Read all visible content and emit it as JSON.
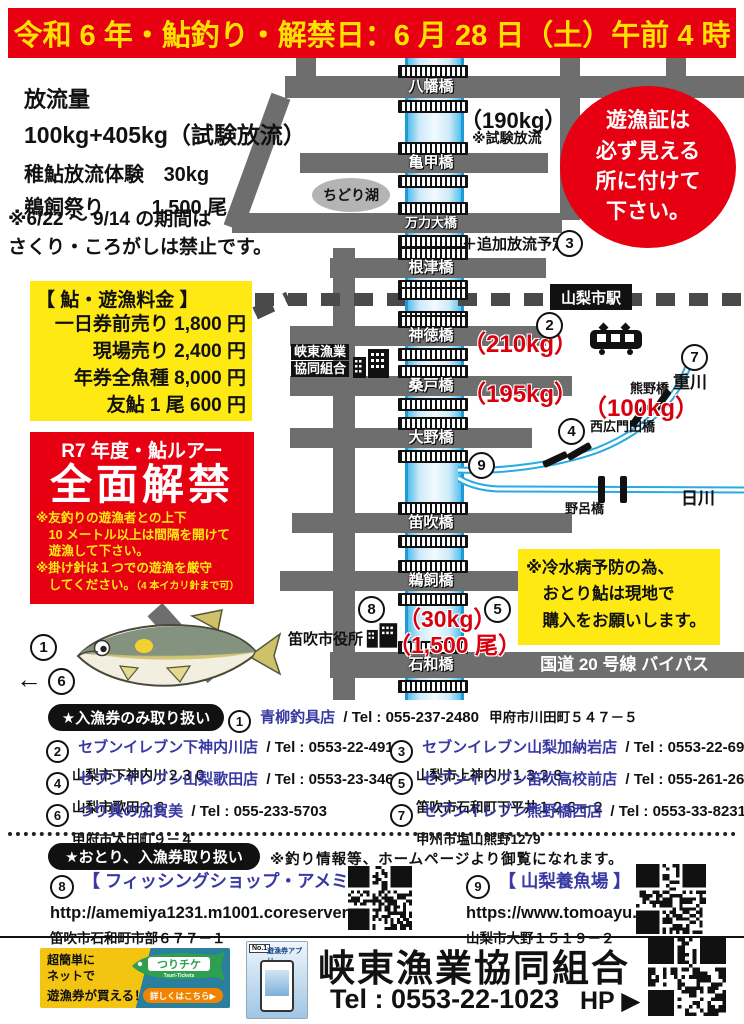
{
  "header": {
    "title": "令和 6 年・鮎釣り・解禁日：6 月 28 日（土）午前 4 時"
  },
  "info": {
    "title": "放流量",
    "amount": "100kg+405kg（試験放流）",
    "row1_label": "稚鮎放流体験",
    "row1_value": "30kg",
    "row2_label": "鵜飼祭り",
    "row2_value": "1,500 尾",
    "note_line1": "※6/22 ～ 9/14 の期間は",
    "note_line2": "さくり・ころがしは禁止です。"
  },
  "license_notice": {
    "lines": [
      "遊漁証は",
      "必ず見える",
      "所に付けて",
      "下さい。"
    ]
  },
  "fees": {
    "title": "【 鮎・遊漁料金 】",
    "items": [
      "一日券前売り 1,800 円",
      "現場売り 2,400 円",
      "年券全魚種 8,000 円",
      "友鮎 1 尾 600 円"
    ]
  },
  "lure": {
    "subtitle": "R7 年度・鮎ルアー",
    "title": "全面解禁",
    "note1_lines": [
      "※友釣りの遊漁者との上下",
      "　10 メートル以上は間隔を開けて",
      "　遊漁して下さい。"
    ],
    "note2_line1": "※掛け針は１つでの遊漁を厳守",
    "note2_line2": "　してください。",
    "note2_small": "（4 本イカリ針まで可）"
  },
  "map": {
    "bridges": [
      "八幡橋",
      "亀甲橋",
      "万力大橋",
      "根津橋",
      "神徳橋",
      "桑戸橋",
      "大野橋",
      "笛吹橋",
      "鵜飼橋",
      "石和橋"
    ],
    "lake": "ちどり湖",
    "station": "山梨市駅",
    "coop_line1": "峡東漁業",
    "coop_line2": "協同組合",
    "city_hall": "笛吹市役所",
    "highway": "国道 20 号線 バイパス",
    "stock_190": "（190kg）",
    "stock_190_note": "※試験放流",
    "additional": "＋追加放流予定",
    "stock_210": "（210kg）",
    "stock_195": "（195kg）",
    "kumano_bridge": "熊野橋",
    "stock_100": "（100kg）",
    "nishihiromonda_bridge": "西広門田橋",
    "shige_river": "重川",
    "hi_river": "日川",
    "noro_bridge": "野呂橋",
    "stock_30": "（30kg）",
    "stock_1500": "（1,500 尾）",
    "cold_note_lines": [
      "※冷水病予防の為、",
      "　おとり鮎は現地で",
      "　購入をお願いします。"
    ],
    "arrow_left": "←",
    "markers": {
      "m1": "1",
      "m2": "2",
      "m3": "3",
      "m4": "4",
      "m5": "5",
      "m6": "6",
      "m7": "7",
      "m8": "8",
      "m9": "9"
    }
  },
  "shops": {
    "badge": "★入漁券のみ取り扱い",
    "list": [
      {
        "no": "1",
        "name": "青柳釣具店",
        "tel": "/ Tel : 055-237-2480",
        "addr": "甲府市川田町５４７－５"
      },
      {
        "no": "2",
        "name": "セブンイレブン下神内川店",
        "tel": "/ Tel : 0553-22-4910",
        "addr": "山梨市下神内川２３０"
      },
      {
        "no": "3",
        "name": "セブンイレブン山梨加納岩店",
        "tel": "/ Tel : 0553-22-6990",
        "addr": "山梨市上神内川１３２８"
      },
      {
        "no": "4",
        "name": "セブンイレブン山梨歌田店",
        "tel": "/ Tel : 0553-23-3466",
        "addr": "山梨市歌田２６"
      },
      {
        "no": "5",
        "name": "セブンイレブン笛吹高校前店",
        "tel": "/ Tel : 055-261-2600",
        "addr": "笛吹市石和町下平井１２６－２"
      },
      {
        "no": "6",
        "name": "つり具の加賀美",
        "tel": "/ Tel : 055-233-5703",
        "addr": "甲府市太田町９－４"
      },
      {
        "no": "7",
        "name": "セブンイレブン熊野橋西店",
        "tel": "/ Tel : 0553-33-8231",
        "addr": "甲州市塩山熊野1279"
      }
    ]
  },
  "otori": {
    "badge": "★おとり、入漁券取り扱い",
    "note": "※釣り情報等、ホームページより御覧になれます。",
    "shop8": {
      "no": "8",
      "name": "【 フィッシングショップ・アメミヤ 】",
      "url": "http://amemiya1231.m1001.coreserver.jp/",
      "addr": "笛吹市石和町市部６７７－１"
    },
    "shop9": {
      "no": "9",
      "name": "【 山梨養魚場 】",
      "url": "https://www.tomoayu.com/",
      "addr": "山梨市大野１５１９－２"
    }
  },
  "footer": {
    "banner": {
      "line1": "超簡単に",
      "line2": "ネットで",
      "line3": "遊漁券が買える！",
      "logo": "つりチケ",
      "logo_sub": "Tsuri-Tickets",
      "button": "詳しくはこちら▶"
    },
    "app": {
      "badge": "No.1",
      "title": "遊漁券アプリ"
    },
    "org": "峡東漁業協同組合",
    "tel": "Tel : 0553-22-1023",
    "hp": "HP ▶"
  },
  "colors": {
    "accent_red": "#e60012",
    "accent_yellow": "#ffe912",
    "river_blue": "#1d9ad6",
    "link_blue": "#3939a3"
  }
}
